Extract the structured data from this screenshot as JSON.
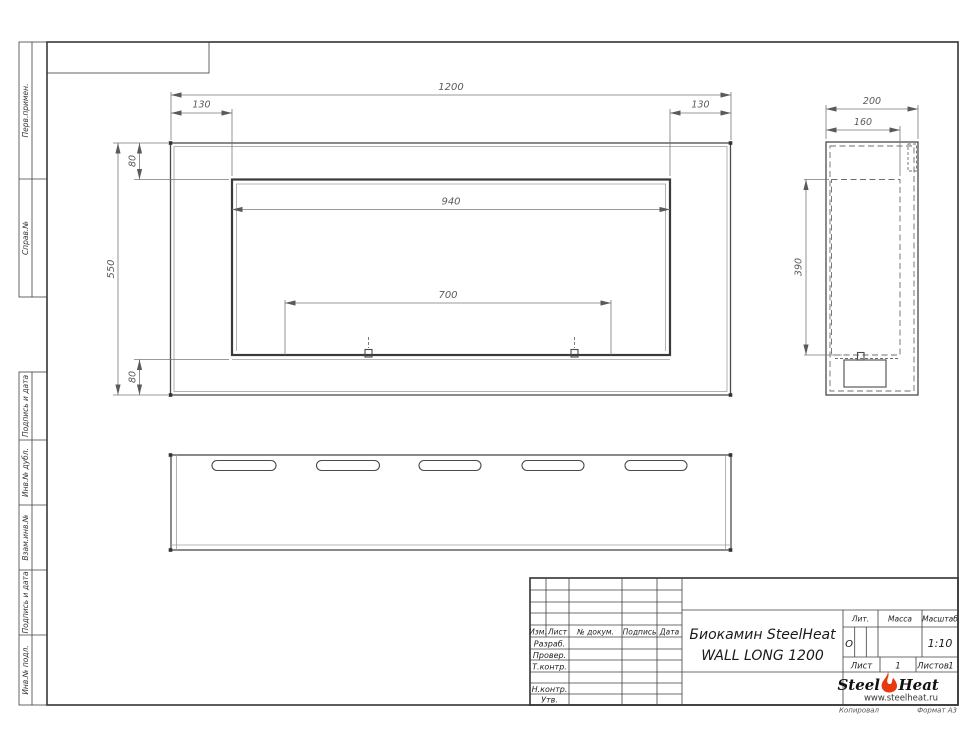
{
  "sheet": {
    "margin_labels": [
      "Перв.примен.",
      "Справ.№",
      "Подпись и дата",
      "Инв.№ дубл.",
      "Взам.инв.№",
      "Подпись и дата",
      "Инв.№ подл."
    ],
    "footer_left": "Копировал",
    "footer_right": "Формат А3"
  },
  "dims": {
    "front": {
      "width": "1200",
      "left_offset": "130",
      "right_offset": "130",
      "opening_width": "940",
      "burner_span": "700",
      "height": "550",
      "top_flange": "80",
      "bottom_flange": "80"
    },
    "side": {
      "depth": "200",
      "inner_depth": "160",
      "opening_height": "390"
    }
  },
  "title_block": {
    "header_cols": [
      "Изм.",
      "Лист",
      "№ докум.",
      "Подпись",
      "Дата"
    ],
    "sign_rows": [
      "Разраб.",
      "Провер.",
      "Т.контр.",
      "Н.контр.",
      "Утв."
    ],
    "doc_title_line1": "Биокамин SteelHeat",
    "doc_title_line2": "WALL LONG 1200",
    "lit_label": "Лит.",
    "lit_value": "О",
    "mass_label": "Масса",
    "scale_label": "Масштаб",
    "scale_value": "1:10",
    "sheet_label": "Лист",
    "sheet_value": "1",
    "sheets_label": "Листов",
    "sheets_value": "1"
  },
  "logo": {
    "brand_part1": "Steel",
    "brand_part2": "Heat",
    "website": "www.steelheat.ru",
    "flame_color": "#e8380d"
  }
}
